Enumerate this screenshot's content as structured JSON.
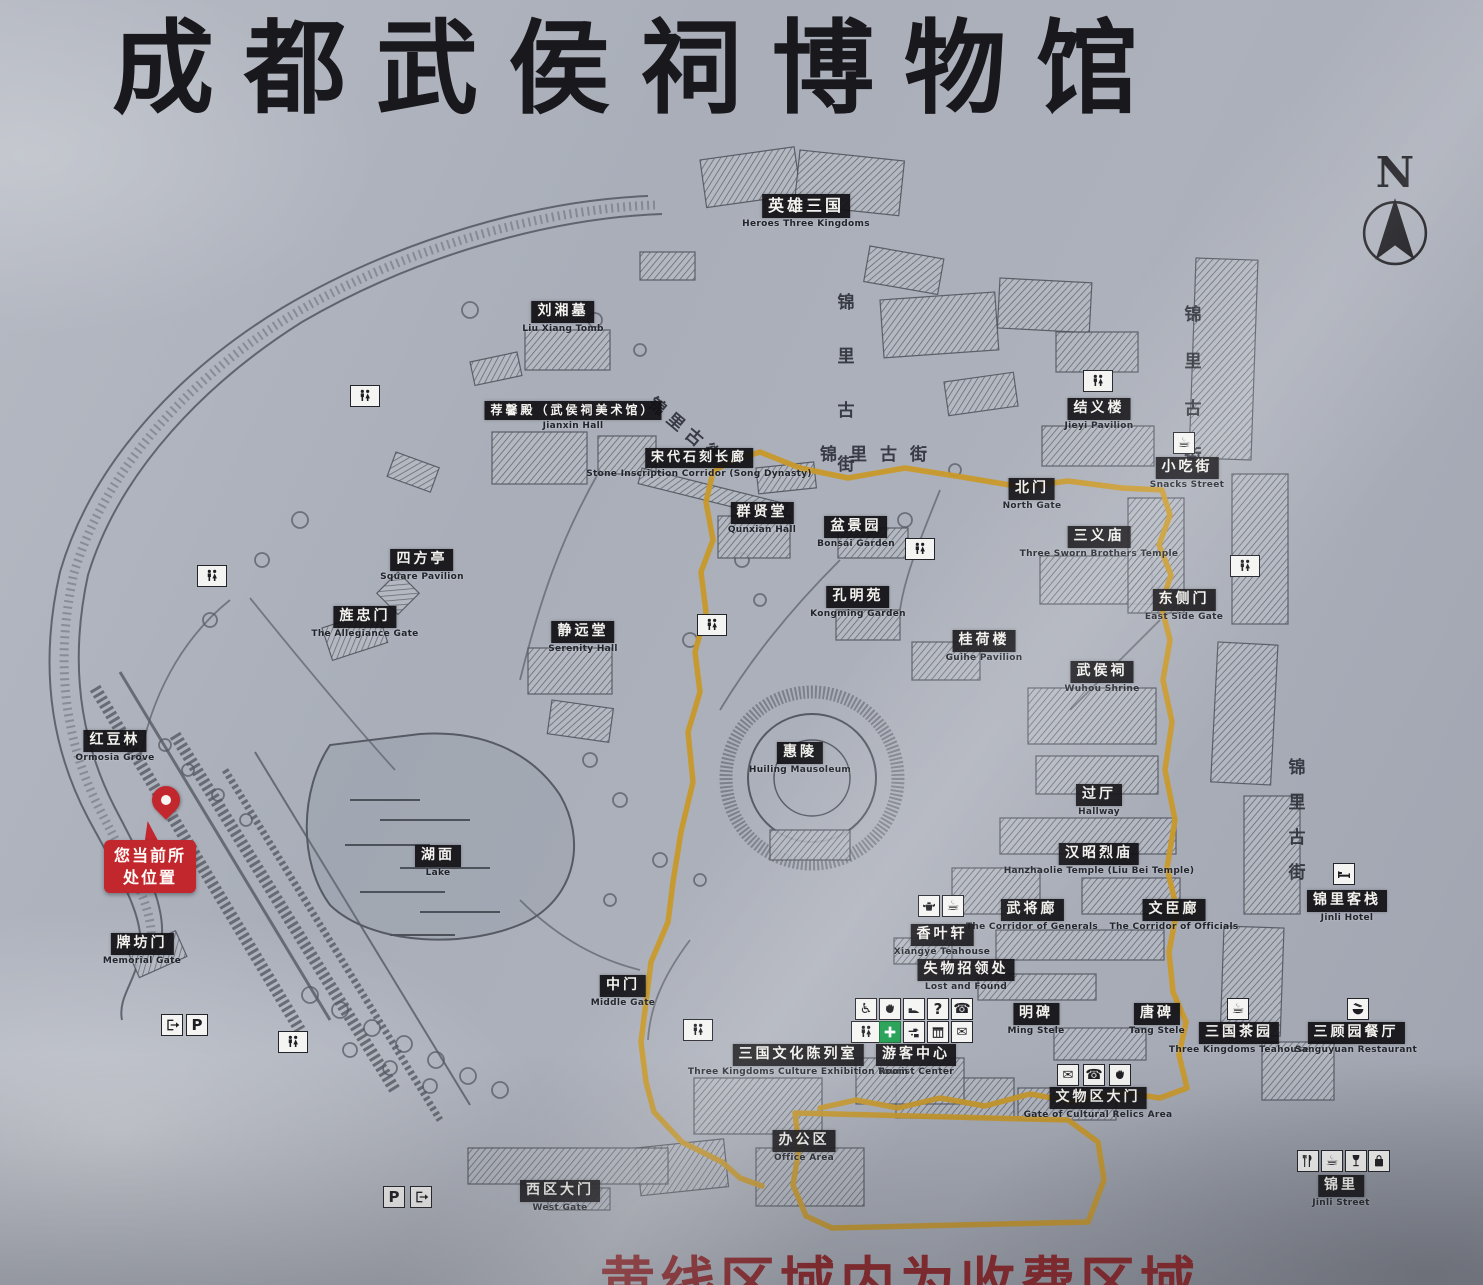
{
  "title": "成都武侯祠博物馆",
  "compass_label": "N",
  "current_location": {
    "line1": "您当前所",
    "line2": "处位置"
  },
  "fee_notice": "黄线区域内为收费区域",
  "colors": {
    "board_gray": "#aab0ba",
    "label_bg": "#141418",
    "label_text": "#f3f2ee",
    "route_yellow": "#c9992a",
    "alert_red": "#c3272e",
    "notice_red": "#8f2125",
    "line_gray": "#565a63",
    "firstaid_green": "#1f9e50"
  },
  "places": [
    {
      "cn": "英雄三国",
      "en": "Heroes Three Kingdoms",
      "x": 806,
      "y": 194,
      "fs": 16
    },
    {
      "cn": "刘湘墓",
      "en": "Liu Xiang Tomb",
      "x": 563,
      "y": 300
    },
    {
      "cn": "荐馨殿（武侯祠美术馆）",
      "en": "Jianxin Hall",
      "x": 573,
      "y": 399,
      "fs": 12
    },
    {
      "cn": "宋代石刻长廊",
      "en": "Stone Inscription Corridor (Song Dynasty)",
      "x": 699,
      "y": 446,
      "fs": 13
    },
    {
      "cn": "群贤堂",
      "en": "Qunxian Hall",
      "x": 762,
      "y": 501
    },
    {
      "cn": "盆景园",
      "en": "Bonsai Garden",
      "x": 856,
      "y": 515
    },
    {
      "cn": "孔明苑",
      "en": "Kongming Garden",
      "x": 858,
      "y": 585
    },
    {
      "cn": "北门",
      "en": "North Gate",
      "x": 1032,
      "y": 477
    },
    {
      "cn": "结义楼",
      "en": "Jieyi Pavilion",
      "x": 1099,
      "y": 397
    },
    {
      "cn": "小吃街",
      "en": "Snacks Street",
      "x": 1187,
      "y": 456
    },
    {
      "cn": "三义庙",
      "en": "Three Sworn Brothers Temple",
      "x": 1099,
      "y": 525
    },
    {
      "cn": "东侧门",
      "en": "East Side Gate",
      "x": 1184,
      "y": 588
    },
    {
      "cn": "四方亭",
      "en": "Square Pavilion",
      "x": 422,
      "y": 548
    },
    {
      "cn": "旌忠门",
      "en": "The Allegiance Gate",
      "x": 365,
      "y": 605
    },
    {
      "cn": "静远堂",
      "en": "Serenity Hall",
      "x": 583,
      "y": 620
    },
    {
      "cn": "红豆林",
      "en": "Ormosia Grove",
      "x": 115,
      "y": 729
    },
    {
      "cn": "湖面",
      "en": "Lake",
      "x": 438,
      "y": 844
    },
    {
      "cn": "惠陵",
      "en": "Huiling Mausoleum",
      "x": 800,
      "y": 741
    },
    {
      "cn": "桂荷楼",
      "en": "Guihe Pavilion",
      "x": 984,
      "y": 629
    },
    {
      "cn": "武侯祠",
      "en": "Wuhou Shrine",
      "x": 1102,
      "y": 660
    },
    {
      "cn": "过厅",
      "en": "Hallway",
      "x": 1099,
      "y": 783
    },
    {
      "cn": "汉昭烈庙",
      "en": "Hanzhaolie Temple (Liu Bei Temple)",
      "x": 1099,
      "y": 842
    },
    {
      "cn": "武将廊",
      "en": "The Corridor of Generals",
      "x": 1032,
      "y": 898
    },
    {
      "cn": "文臣廊",
      "en": "The Corridor of Officials",
      "x": 1174,
      "y": 898
    },
    {
      "cn": "香叶轩",
      "en": "Xiangye Teahouse",
      "x": 942,
      "y": 923
    },
    {
      "cn": "失物招领处",
      "en": "Lost and Found",
      "x": 966,
      "y": 958
    },
    {
      "cn": "明碑",
      "en": "Ming Stele",
      "x": 1036,
      "y": 1002
    },
    {
      "cn": "唐碑",
      "en": "Tang Stele",
      "x": 1157,
      "y": 1002
    },
    {
      "cn": "游客中心",
      "en": "Tourist Center",
      "x": 916,
      "y": 1043
    },
    {
      "cn": "三国文化陈列室",
      "en": "Three Kingdoms Culture Exhibition Room",
      "x": 798,
      "y": 1043
    },
    {
      "cn": "中门",
      "en": "Middle Gate",
      "x": 623,
      "y": 974
    },
    {
      "cn": "牌坊门",
      "en": "Memorial Gate",
      "x": 142,
      "y": 932
    },
    {
      "cn": "文物区大门",
      "en": "Gate of Cultural Relics Area",
      "x": 1098,
      "y": 1086
    },
    {
      "cn": "三国茶园",
      "en": "Three Kingdoms Teahouse",
      "x": 1239,
      "y": 1021
    },
    {
      "cn": "三顾园餐厅",
      "en": "Sanguyuan Restaurant",
      "x": 1356,
      "y": 1021
    },
    {
      "cn": "锦里客栈",
      "en": "Jinli Hotel",
      "x": 1347,
      "y": 889
    },
    {
      "cn": "办公区",
      "en": "Office Area",
      "x": 804,
      "y": 1129
    },
    {
      "cn": "西区大门",
      "en": "West Gate",
      "x": 560,
      "y": 1179
    },
    {
      "cn": "锦里",
      "en": "Jinli Street",
      "x": 1341,
      "y": 1174
    }
  ],
  "streets": [
    {
      "text": "锦里古街",
      "x": 846,
      "y": 288,
      "dir": "v",
      "gap": 46
    },
    {
      "text": "锦里古街",
      "x": 660,
      "y": 390,
      "dir": "r",
      "rot": 40
    },
    {
      "text": "锦里古街",
      "x": 880,
      "y": 440,
      "dir": "h"
    },
    {
      "text": "锦里古街",
      "x": 1193,
      "y": 300,
      "dir": "v",
      "gap": 39
    },
    {
      "text": "锦里古街",
      "x": 1297,
      "y": 753,
      "dir": "v",
      "gap": 27
    }
  ],
  "icons": [
    {
      "t": "restroom",
      "x": 365,
      "y": 396
    },
    {
      "t": "restroom",
      "x": 212,
      "y": 576
    },
    {
      "t": "restroom",
      "x": 712,
      "y": 625
    },
    {
      "t": "restroom",
      "x": 920,
      "y": 549
    },
    {
      "t": "restroom",
      "x": 1098,
      "y": 381
    },
    {
      "t": "restroom",
      "x": 1245,
      "y": 566
    },
    {
      "t": "restroom",
      "x": 698,
      "y": 1030
    },
    {
      "t": "restroom",
      "x": 293,
      "y": 1042
    },
    {
      "t": "cafe",
      "x": 1184,
      "y": 443
    },
    {
      "t": "teapot",
      "x": 929,
      "y": 906
    },
    {
      "t": "cafe",
      "x": 953,
      "y": 906
    },
    {
      "t": "bed",
      "x": 1344,
      "y": 874
    },
    {
      "t": "cafe",
      "x": 1238,
      "y": 1009
    },
    {
      "t": "bowl",
      "x": 1358,
      "y": 1009
    },
    {
      "t": "restaurant",
      "x": 1308,
      "y": 1161
    },
    {
      "t": "cafe",
      "x": 1332,
      "y": 1161
    },
    {
      "t": "wine",
      "x": 1356,
      "y": 1161
    },
    {
      "t": "bag",
      "x": 1379,
      "y": 1161
    },
    {
      "t": "wheelchair",
      "x": 866,
      "y": 1009
    },
    {
      "t": "hand",
      "x": 890,
      "y": 1009
    },
    {
      "t": "shoe",
      "x": 914,
      "y": 1009
    },
    {
      "t": "question",
      "x": 938,
      "y": 1009
    },
    {
      "t": "phone",
      "x": 962,
      "y": 1009
    },
    {
      "t": "restroom",
      "x": 866,
      "y": 1032
    },
    {
      "t": "firstaid",
      "x": 890,
      "y": 1032
    },
    {
      "t": "tap",
      "x": 914,
      "y": 1032
    },
    {
      "t": "kiosk",
      "x": 938,
      "y": 1032
    },
    {
      "t": "envelope",
      "x": 962,
      "y": 1032
    },
    {
      "t": "envelope",
      "x": 1068,
      "y": 1075
    },
    {
      "t": "phone",
      "x": 1094,
      "y": 1075
    },
    {
      "t": "hand",
      "x": 1120,
      "y": 1075
    },
    {
      "t": "exit",
      "x": 172,
      "y": 1025
    },
    {
      "t": "parking",
      "x": 197,
      "y": 1025
    },
    {
      "t": "parking",
      "x": 394,
      "y": 1197
    },
    {
      "t": "exit",
      "x": 421,
      "y": 1197
    }
  ]
}
